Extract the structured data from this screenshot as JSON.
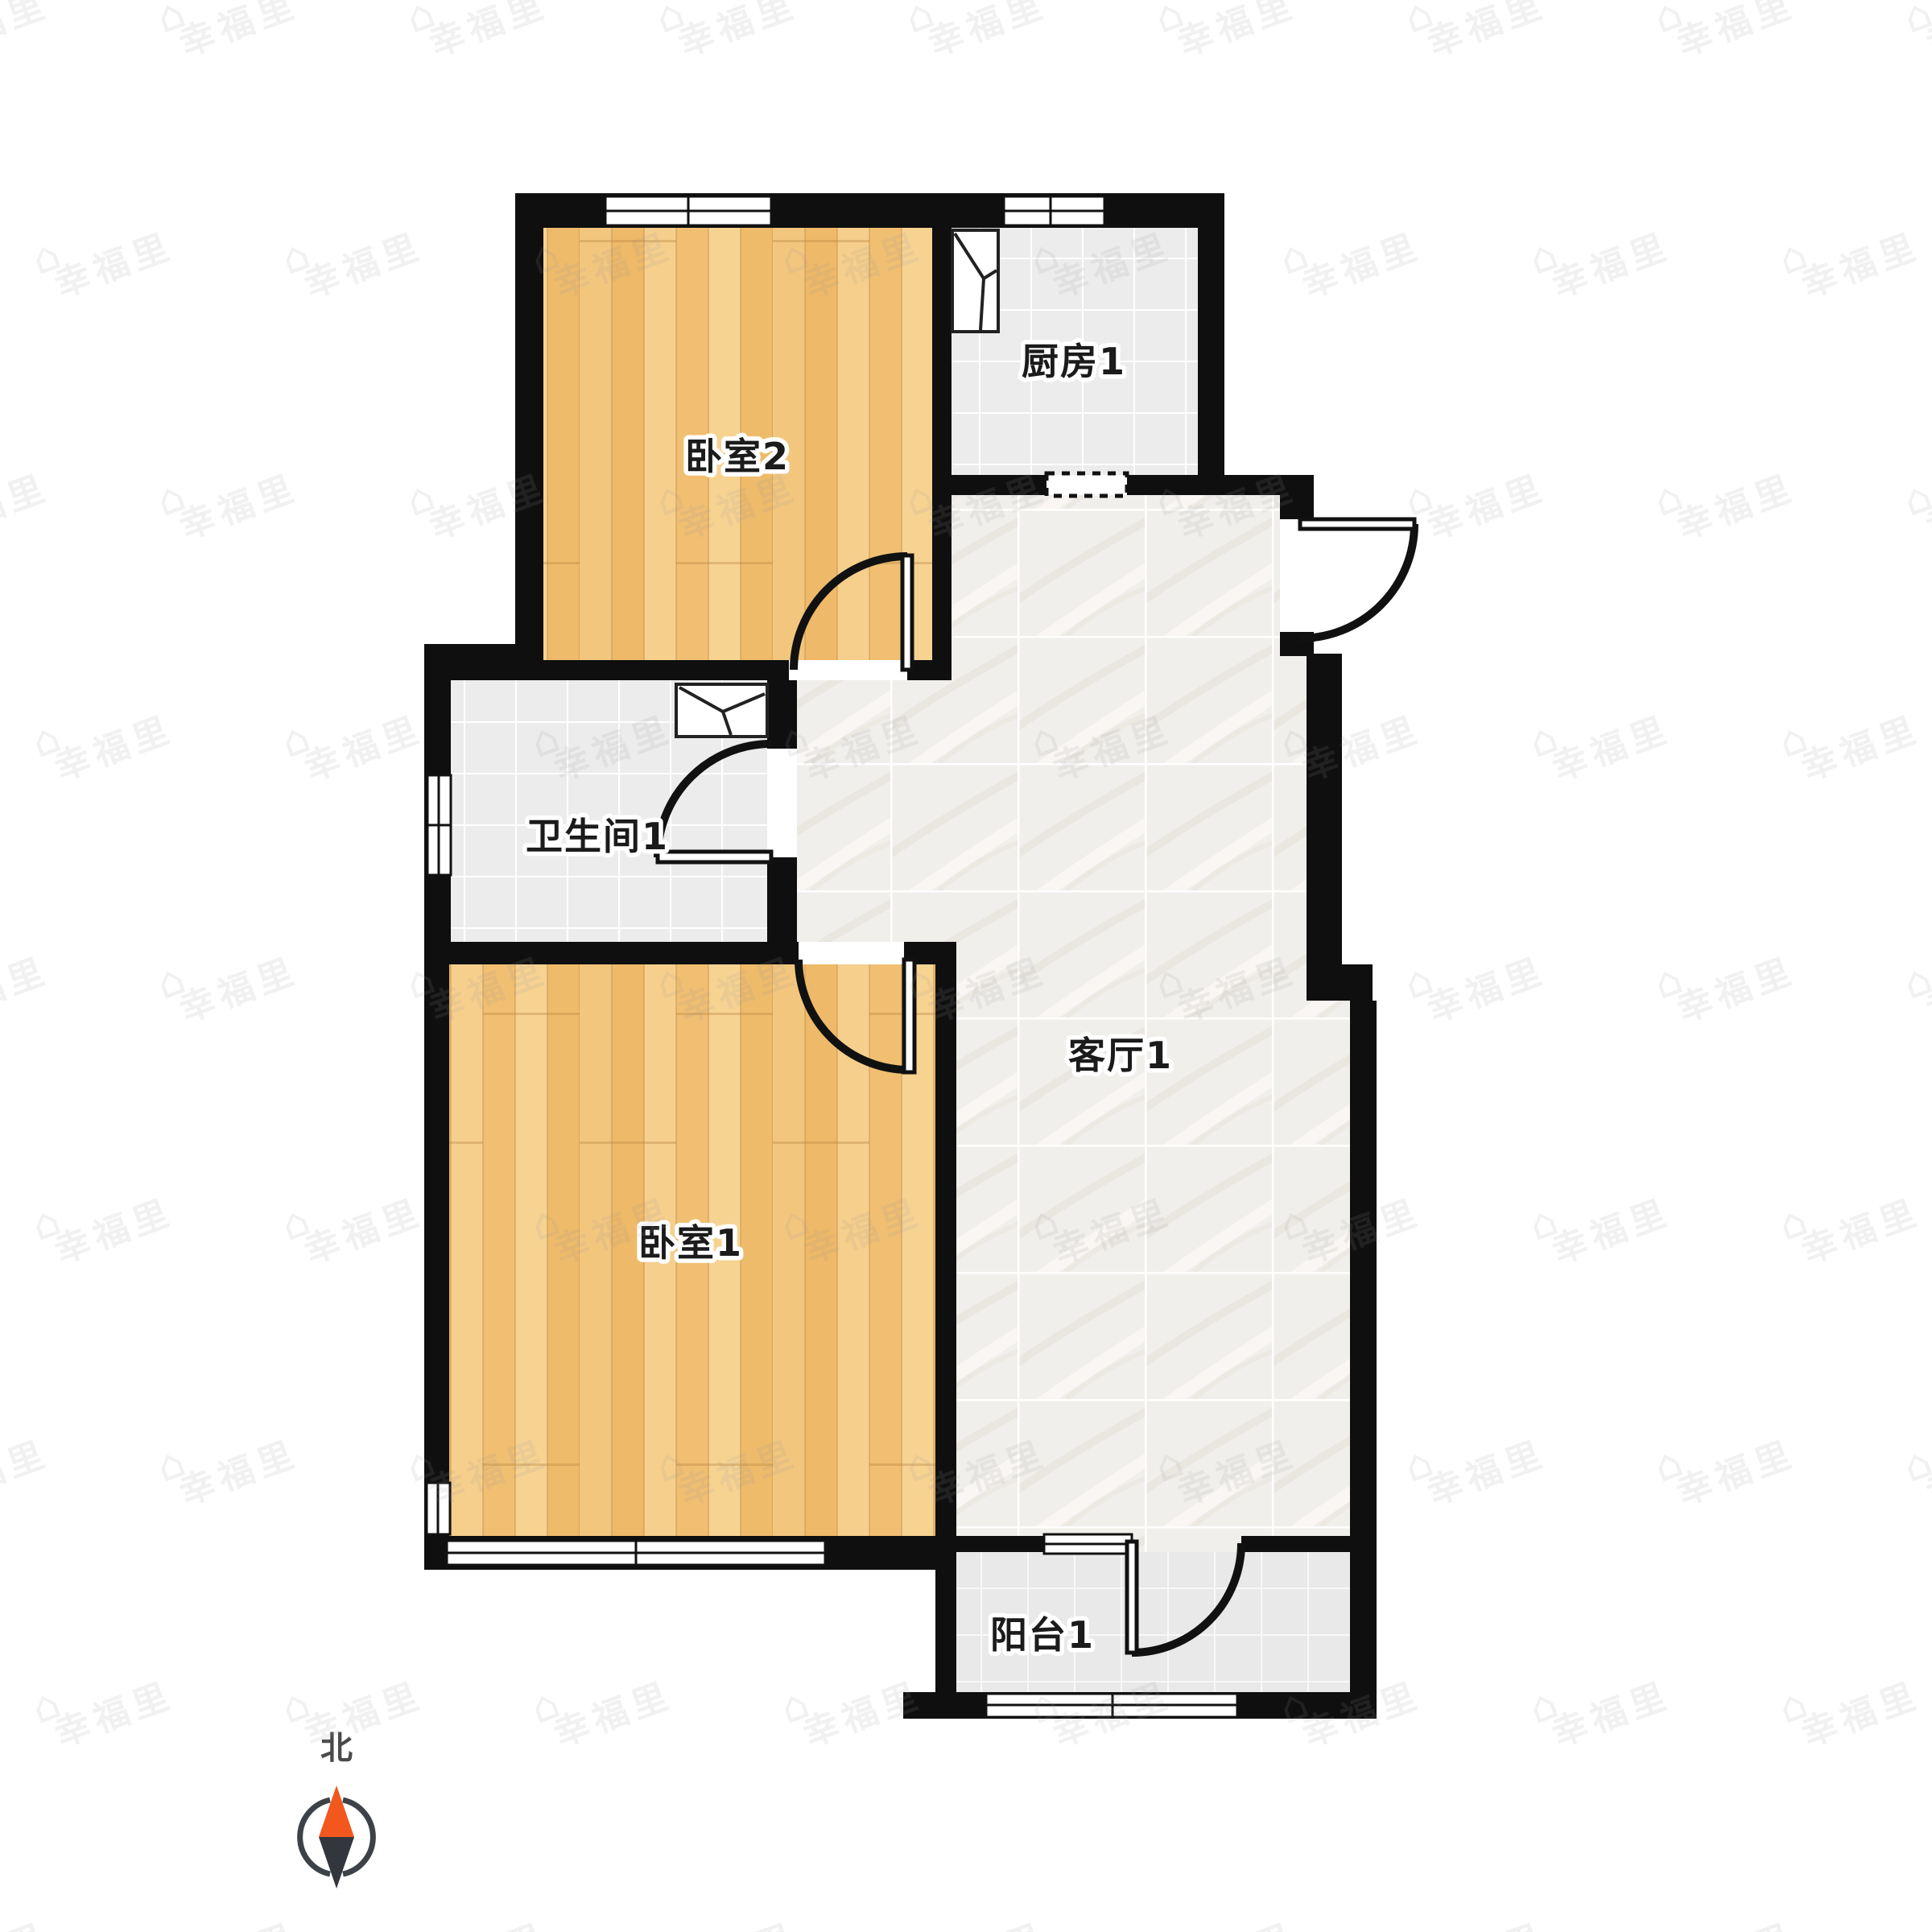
{
  "rooms": {
    "bedroom2": {
      "label": "卧室2"
    },
    "kitchen": {
      "label": "厨房1"
    },
    "bathroom": {
      "label": "卫生间1"
    },
    "bedroom1": {
      "label": "卧室1"
    },
    "living": {
      "label": "客厅1"
    },
    "balcony": {
      "label": "阳台1"
    }
  },
  "compass": {
    "label": "北",
    "north_color": "#f2571d",
    "south_color": "#33373d",
    "ring_color": "#3d4248",
    "label_color": "#4a4a4a"
  },
  "watermark": {
    "text": "幸福里",
    "icon": "⌂",
    "color": "#9a9a9a",
    "opacity": 0.14,
    "rotation": -20,
    "rows": 9,
    "cols": 9,
    "x_step": 310,
    "y_step": 300
  },
  "palette": {
    "wall": "#0f0f0f",
    "door": "#111111",
    "label": "#1b1b1b",
    "wood_base": "#f2c377",
    "tile_base": "#ececec",
    "marble_base": "#f1efeb",
    "balcony_base": "#e9e9e9"
  }
}
